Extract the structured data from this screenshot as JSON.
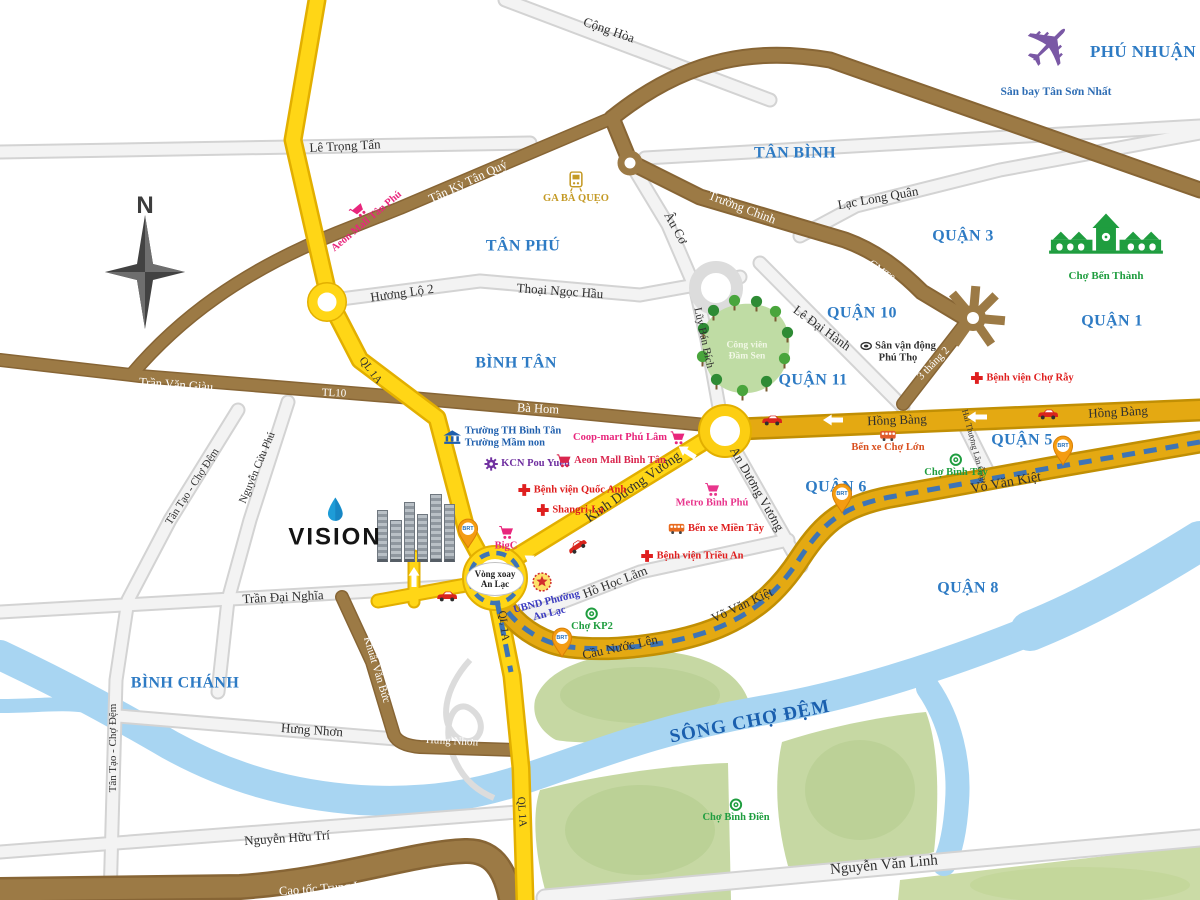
{
  "districts": {
    "phu_nhuan": "PHÚ NHUẬN",
    "tan_binh": "TÂN BÌNH",
    "tan_phu": "TÂN PHÚ",
    "quan_3": "QUẬN 3",
    "quan_1": "QUẬN 1",
    "quan_10": "QUẬN 10",
    "quan_11": "QUẬN 11",
    "quan_5": "QUẬN 5",
    "quan_6": "QUẬN 6",
    "quan_8": "QUẬN 8",
    "binh_tan": "BÌNH TÂN",
    "binh_chanh": "BÌNH CHÁNH"
  },
  "roads": {
    "le_trong_tan": "Lê Trọng Tấn",
    "cong_hoa": "Cộng Hòa",
    "tan_ky_tan_quy": "Tân Kỳ Tân Quý",
    "truong_chinh": "Trường Chinh",
    "hoang_van_thu": "Hoàng Văn Thụ",
    "lac_long_quan": "Lạc Long Quân",
    "cmt8": "CMT8",
    "au_co": "Âu Cơ",
    "huong_lo_2": "Hương Lộ 2",
    "thoai_ngoc_hau": "Thoại Ngọc Hầu",
    "luy_ban_bich": "Lũy Bán Bích",
    "le_dai_hanh": "Lê Đại Hành",
    "ba_thang_2": "3 tháng 2",
    "tran_van_giau": "Trần Văn Giàu",
    "tl10": "TL10",
    "ba_hom": "Bà Hom",
    "hong_bang": "Hồng Bàng",
    "kinh_duong_vuong": "Kinh Dương Vương",
    "an_duong_vuong": "An Dương Vương",
    "hai_thuong_lan_ong": "Hải Thượng Lãn Ông",
    "vo_van_kiet": "Võ Văn Kiệt",
    "ql_1a": "QL 1A",
    "ho_hoc_lam": "Hồ Học Lãm",
    "cau_nuoc_len": "Cầu Nước Lên",
    "tran_dai_nghia": "Trần Đại Nghĩa",
    "tan_tao_cho_dem": "Tân Tạo - Chợ Đệm",
    "nguyen_cuu_phu": "Nguyễn Cửu Phú",
    "khuat_van_buc": "Khuất Văn Bức",
    "hung_nhon": "Hưng Nhơn",
    "nguyen_huu_tri": "Nguyễn Hữu Trí",
    "cao_toc_trung_luong": "Cao tốc Trung Lương",
    "nguyen_van_linh": "Nguyễn Văn Linh"
  },
  "pois": {
    "airport": "Sân bay Tân Sơn Nhất",
    "ga_ba_queo": "GA BÀ QUẸO",
    "aeon_tan_phu": "Aeon Mall Tân Phú",
    "cho_ben_thanh": "Chợ Bến Thành",
    "bv_cho_ray": "Bệnh viện Chợ Rẫy",
    "dam_sen_1": "Công viên",
    "dam_sen_2": "Đầm Sen",
    "svd_1": "Sân vận động",
    "svd_2": "Phú Thọ",
    "truong_th": "Trường TH Bình Tân",
    "truong_mam_non": "Trường Mầm non",
    "coop_mart": "Coop-mart Phú Lâm",
    "kcn": "KCN Pou Yuen",
    "aeon_binh_tan": "Aeon Mall Bình Tân",
    "bv_quoc_anh": "Bệnh viện Quốc Anh",
    "shangri_la": "Shangri-La",
    "metro": "Metro Bình Phú",
    "bx_mien_tay": "Bến xe Miền Tây",
    "bv_trieu_an": "Bệnh viện Triều An",
    "bx_cho_lon": "Bến xe Chợ Lớn",
    "cho_binh_tay": "Chợ Bình Tây",
    "big_c": "BigC",
    "vong_xoay_1": "Vòng xoay",
    "vong_xoay_2": "An Lạc",
    "ubnd_1": "UBND Phường",
    "ubnd_2": "An Lạc",
    "cho_kp2": "Chợ KP2",
    "cho_binh_dien": "Chợ Bình Điền"
  },
  "labels": {
    "river": "SÔNG CHỢ ĐỆM",
    "brt": "BRT",
    "compass": "N",
    "vision": "VISION"
  },
  "icons": {
    "plane": "✈"
  },
  "colors": {
    "highway_yellow": "#FFD616",
    "boulevard_gold": "#E4A912",
    "road_brown": "#9C7A45",
    "road_gray": "#F3F3F3",
    "river_blue": "#A8D5F2",
    "land_green": "#C6D8A3",
    "district_blue": "#2E7BC4",
    "brt_dash_blue": "#3E74B5",
    "poi_pink": "#E8267C",
    "poi_red": "#DF1F1F",
    "poi_green": "#1F9D3F",
    "poi_purple": "#7030A0",
    "poi_gold": "#C49A25",
    "pin_orange": "#F49C12"
  }
}
